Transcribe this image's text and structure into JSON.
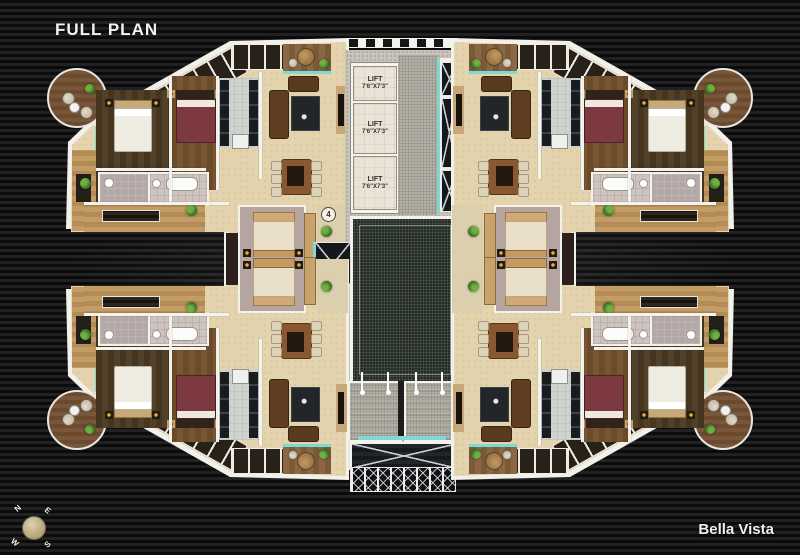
{
  "header": {
    "title": "FULL PLAN"
  },
  "footer": {
    "brand": "Bella Vista"
  },
  "core": {
    "lifts": [
      {
        "label": "LIFT",
        "size": "7'6\"X7'3\""
      },
      {
        "label": "LIFT",
        "size": "7'6\"X7'3\""
      },
      {
        "label": "LIFT",
        "size": "7'6\"X7'3\""
      }
    ]
  },
  "unit_badges": [
    {
      "number": "4"
    },
    {
      "number": "1"
    },
    {
      "number": "3"
    },
    {
      "number": "2"
    }
  ],
  "compass": {
    "north": "N",
    "east": "E",
    "south": "S",
    "west": "W"
  },
  "colors": {
    "accent_teal": "#7fd8d4",
    "wall_white": "#f4f2ec",
    "floor_beige": "#e4d4ae",
    "courtyard_granite": "#262c27",
    "background_stripe": "#151515"
  }
}
